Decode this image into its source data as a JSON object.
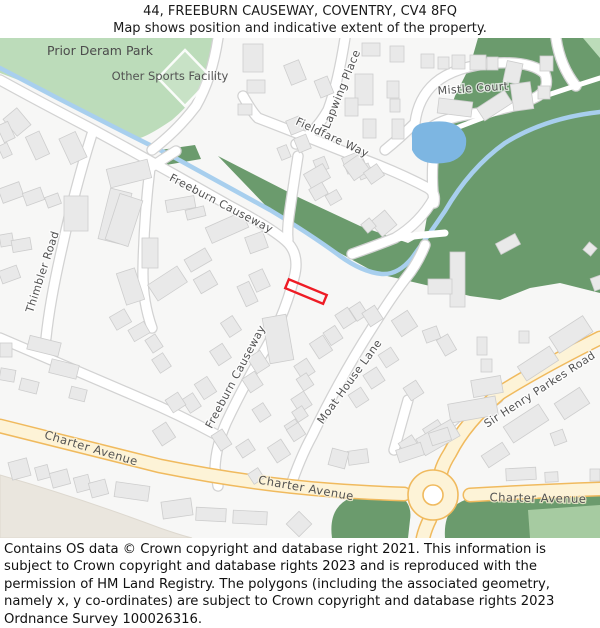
{
  "header": {
    "title": "44, FREEBURN CAUSEWAY, COVENTRY, CV4 8FQ",
    "subtitle": "Map shows position and indicative extent of the property."
  },
  "map": {
    "labels": {
      "park": "Prior Deram Park",
      "sports_facility": "Other Sports Facility",
      "lapwing_place": "Lapwing Place",
      "mistle_court": "Mistle Court",
      "fieldfare_way": "Fieldfare Way",
      "freeburn_upper": "Freeburn Causeway",
      "freeburn_lower": "Freeburn Causeway",
      "thimbler_road": "Thimbler Road",
      "moat_house_lane": "Moat House Lane",
      "sir_henry_parkes": "Sir Henry Parkes Road",
      "charter_avenue_1": "Charter Avenue",
      "charter_avenue_2": "Charter Avenue",
      "charter_avenue_3": "Charter Avenue"
    },
    "colors": {
      "park_green": "#bcdcba",
      "woods_green": "#6b9b6d",
      "light_green": "#a6cba1",
      "pond_blue": "#7db6e2",
      "stream_blue": "#a8cfee",
      "road_yellow_fill": "#fdf3d7",
      "road_yellow_border": "#f0ba5e",
      "road_white": "#ffffff",
      "building_fill": "#e9e9e9",
      "building_border": "#cdcdcd",
      "beige_area": "#eae6de",
      "plot_red": "#ee1c25"
    }
  },
  "footer": {
    "attribution": "Contains OS data © Crown copyright and database right 2021. This information is subject to Crown copyright and database rights 2023 and is reproduced with the permission of HM Land Registry. The polygons (including the associated geometry, namely x, y co-ordinates) are subject to Crown copyright and database rights 2023 Ordnance Survey 100026316."
  }
}
